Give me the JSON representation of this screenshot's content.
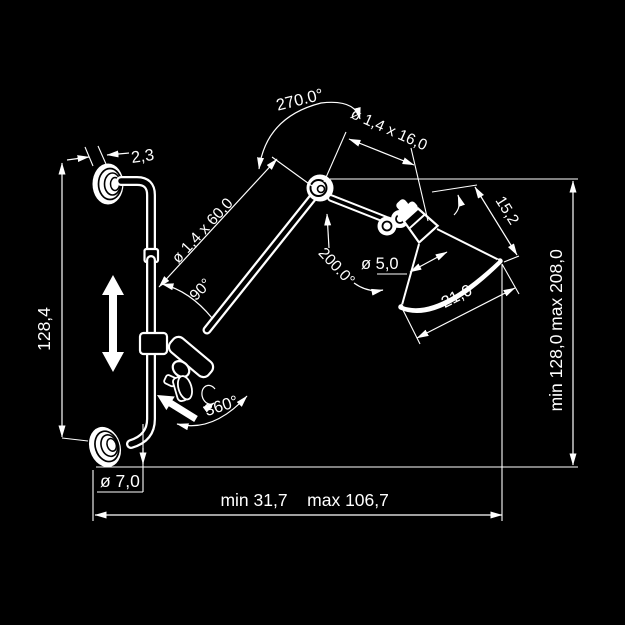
{
  "canvas": {
    "background": "#000000",
    "ink": "#ffffff"
  },
  "figure": {
    "kind": "technical dimension drawing",
    "subject": "articulated wall-mounted lamp with two wall flanges, sliding rail clamp, two-section arm and conical shade"
  },
  "labels": {
    "flange_thickness": "2,3",
    "rail_length": "128,4",
    "elbow_rotation": "270.0°",
    "upper_arm_tube": "ø 1,4 x 60,0",
    "clamp_angle": "90°",
    "forearm_tube": "ø 1,4 x 16,0",
    "head_rotation": "200.0°",
    "shade_neck_diameter": "ø 5,0",
    "shade_height": "15,2",
    "shade_diameter": "21,0",
    "knob_rotation": "360°",
    "flange_diameter": "ø 7,0",
    "reach_min": "min 31,7",
    "reach_max": "max 106,7",
    "height_min": "min 128,0",
    "height_max": "max 208,0"
  }
}
